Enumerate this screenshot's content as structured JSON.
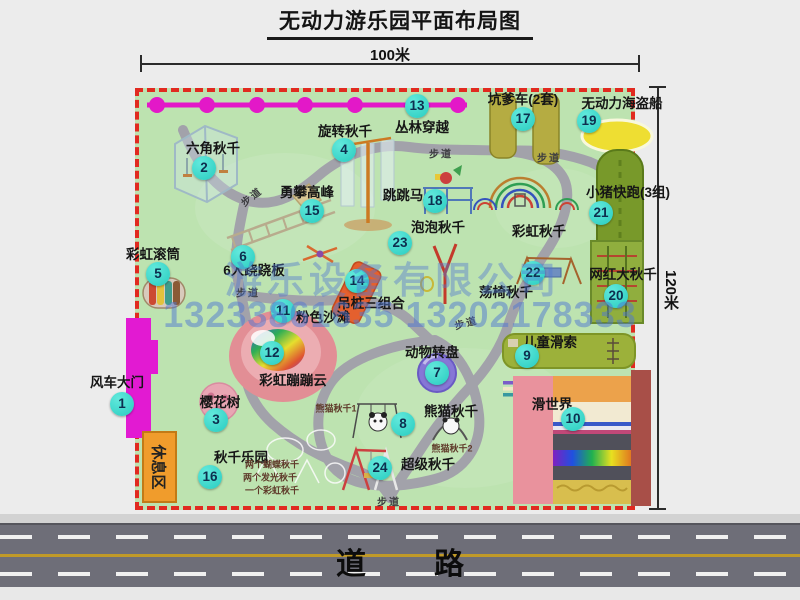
{
  "title": "无动力游乐园平面布局图",
  "dimensions": {
    "top": "100米",
    "right": "120米"
  },
  "road": {
    "label": "道路"
  },
  "rest_area": {
    "label": "休息区"
  },
  "watermark": {
    "company": "游乐设备有限公司",
    "phone": "13233861635 13202178333"
  },
  "colors": {
    "map-green": "#bde3b0",
    "border-red": "#e12a20",
    "badge-cyan": "#28ccc0",
    "zipline-magenta": "#e318c8",
    "road-gray": "#6e6e78",
    "wm-blue": "#5078d2",
    "rest-orange": "#f09c2c"
  },
  "attractions": [
    {
      "num": 1,
      "name": "风车大门",
      "bx": 122,
      "by": 404,
      "lx": 117,
      "ly": 381
    },
    {
      "num": 2,
      "name": "六角秋千",
      "bx": 204,
      "by": 168,
      "lx": 213,
      "ly": 147
    },
    {
      "num": 3,
      "name": "樱花树",
      "bx": 216,
      "by": 420,
      "lx": 220,
      "ly": 401
    },
    {
      "num": 4,
      "name": "旋转秋千",
      "bx": 344,
      "by": 150,
      "lx": 345,
      "ly": 130
    },
    {
      "num": 5,
      "name": "彩虹滚筒",
      "bx": 158,
      "by": 274,
      "lx": 153,
      "ly": 253
    },
    {
      "num": 6,
      "name": "6人跷跷板",
      "bx": 243,
      "by": 257,
      "lx": 254,
      "ly": 269
    },
    {
      "num": 7,
      "name": "动物转盘",
      "bx": 437,
      "by": 373,
      "lx": 432,
      "ly": 351
    },
    {
      "num": 8,
      "name": "熊猫秋千",
      "bx": 403,
      "by": 424,
      "lx": 451,
      "ly": 410
    },
    {
      "num": 9,
      "name": "儿童滑索",
      "bx": 527,
      "by": 356,
      "lx": 550,
      "ly": 341
    },
    {
      "num": 10,
      "name": "滑世界",
      "bx": 573,
      "by": 419,
      "lx": 552,
      "ly": 403
    },
    {
      "num": 11,
      "name": "粉色沙滩",
      "bx": 283,
      "by": 311,
      "lx": 323,
      "ly": 316
    },
    {
      "num": 12,
      "name": "彩虹蹦蹦云",
      "bx": 272,
      "by": 353,
      "lx": 293,
      "ly": 379
    },
    {
      "num": 13,
      "name": "丛林穿越",
      "bx": 417,
      "by": 106,
      "lx": 422,
      "ly": 126
    },
    {
      "num": 14,
      "name": "吊桩三组合",
      "bx": 357,
      "by": 281,
      "lx": 371,
      "ly": 302
    },
    {
      "num": 15,
      "name": "勇攀高峰",
      "bx": 312,
      "by": 211,
      "lx": 307,
      "ly": 191
    },
    {
      "num": 16,
      "name": "秋千乐园",
      "bx": 210,
      "by": 477,
      "lx": 241,
      "ly": 456
    },
    {
      "num": 17,
      "name": "坑爹车(2套)",
      "bx": 523,
      "by": 119,
      "lx": 523,
      "ly": 98
    },
    {
      "num": 18,
      "name": "跳跳马",
      "bx": 435,
      "by": 201,
      "lx": 403,
      "ly": 194
    },
    {
      "num": 19,
      "name": "无动力海盗船",
      "bx": 589,
      "by": 121,
      "lx": 622,
      "ly": 102
    },
    {
      "num": 20,
      "name": "网红大秋千",
      "bx": 616,
      "by": 296,
      "lx": 623,
      "ly": 273
    },
    {
      "num": 21,
      "name": "小猪快跑(3组)",
      "bx": 601,
      "by": 213,
      "lx": 628,
      "ly": 191
    },
    {
      "num": 22,
      "name": "荡椅秋千",
      "bx": 533,
      "by": 273,
      "lx": 506,
      "ly": 291
    },
    {
      "num": 23,
      "name": "泡泡秋千",
      "bx": 400,
      "by": 243,
      "lx": 438,
      "ly": 226
    },
    {
      "num": 24,
      "name": "超级秋千",
      "bx": 380,
      "by": 468,
      "lx": 428,
      "ly": 463
    }
  ],
  "unnumbered_labels": [
    {
      "text": "彩虹秋千",
      "x": 539,
      "y": 230
    }
  ],
  "sub_labels": [
    {
      "text": "熊猫秋千1",
      "x": 336,
      "y": 408
    },
    {
      "text": "熊猫秋千2",
      "x": 452,
      "y": 448
    },
    {
      "text": "两个蝴蝶秋千",
      "x": 272,
      "y": 464
    },
    {
      "text": "两个发光秋千",
      "x": 270,
      "y": 477
    },
    {
      "text": "一个彩虹秋千",
      "x": 272,
      "y": 490
    }
  ],
  "path_labels": [
    {
      "text": "步道",
      "x": 251,
      "y": 196,
      "rot": -38
    },
    {
      "text": "步道",
      "x": 441,
      "y": 153,
      "rot": 0
    },
    {
      "text": "步道",
      "x": 549,
      "y": 157,
      "rot": 0
    },
    {
      "text": "步道",
      "x": 248,
      "y": 292,
      "rot": 0
    },
    {
      "text": "步道",
      "x": 466,
      "y": 322,
      "rot": -15
    },
    {
      "text": "步道",
      "x": 389,
      "y": 501,
      "rot": 0
    }
  ]
}
